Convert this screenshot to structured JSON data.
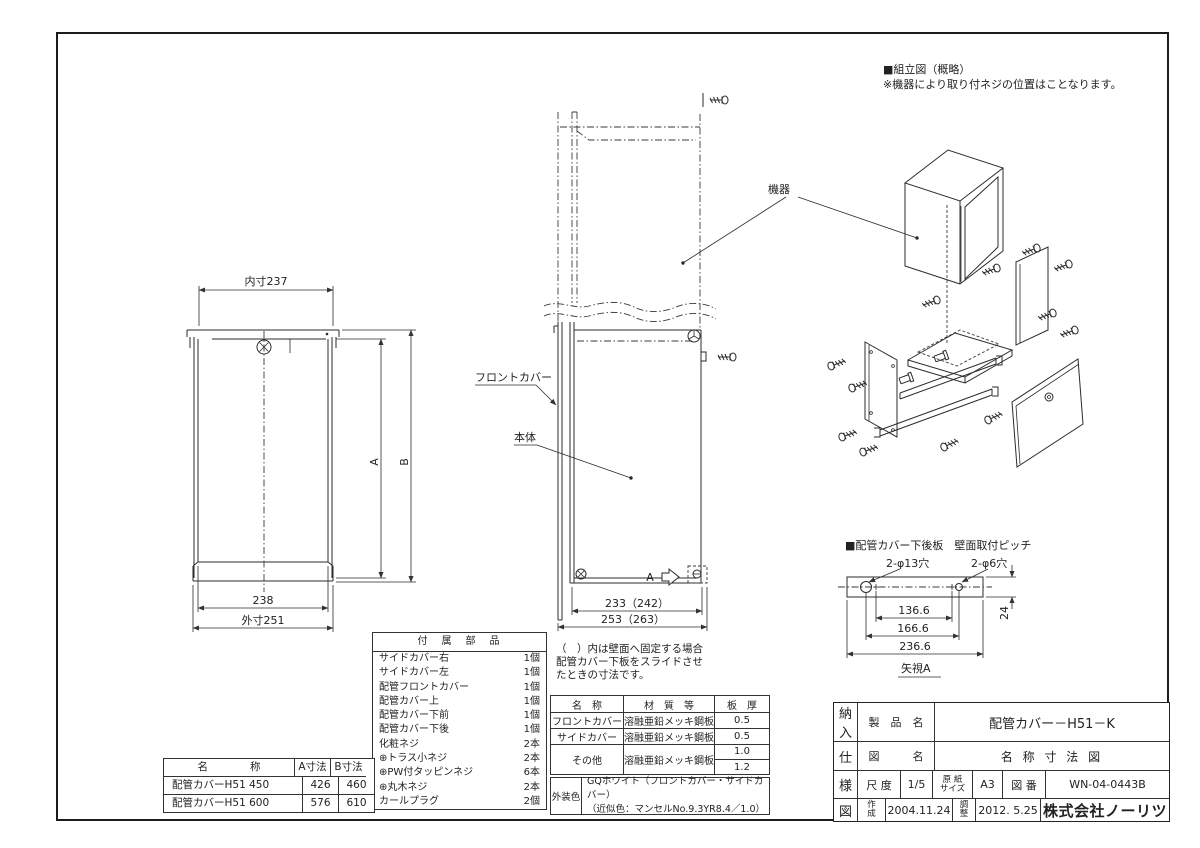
{
  "sheet": {
    "assembly_note_title": "■組立図（概略）",
    "assembly_note_body": "※機器により取り付ネジの位置はことなります。"
  },
  "front_view": {
    "dim_inner_width": "内寸237",
    "dim_width": "238",
    "dim_outer_width": "外寸251",
    "dim_a": "A",
    "dim_b": "B"
  },
  "side_view": {
    "label_front_cover": "フロントカバー",
    "label_body": "本体",
    "label_equipment": "機器",
    "dim_width": "233（242）",
    "dim_outer_width": "253（263）",
    "section_arrow": "A",
    "note_line1": "（　）内は壁面へ固定する場合",
    "note_line2": "配管カバー下板をスライドさせ",
    "note_line3": "たときの寸法です。"
  },
  "pitch_view": {
    "title": "■配管カバー下後板　壁面取付ピッチ",
    "hole_label_left": "2-φ13穴",
    "hole_label_right": "2-φ6穴",
    "dim_hole_pitch": "136.6",
    "dim_hole_centers": "166.6",
    "dim_overall": "236.6",
    "dim_height": "24",
    "view_label": "矢視A"
  },
  "parts_table": {
    "title": "付　属　部　品",
    "rows": [
      {
        "name": "サイドカバー右",
        "qty": "1個"
      },
      {
        "name": "サイドカバー左",
        "qty": "1個"
      },
      {
        "name": "配管フロントカバー",
        "qty": "1個"
      },
      {
        "name": "配管カバー上",
        "qty": "1個"
      },
      {
        "name": "配管カバー下前",
        "qty": "1個"
      },
      {
        "name": "配管カバー下後",
        "qty": "1個"
      },
      {
        "name": "化粧ネジ",
        "qty": "2本"
      },
      {
        "name": "⊕トラス小ネジ",
        "qty": "2本"
      },
      {
        "name": "⊕PW付タッピンネジ",
        "qty": "6本"
      },
      {
        "name": "⊕丸木ネジ",
        "qty": "2本"
      },
      {
        "name": "カールプラグ",
        "qty": "2個"
      }
    ]
  },
  "size_table": {
    "col_name": "名　　　　称",
    "col_a": "A寸法",
    "col_b": "B寸法",
    "rows": [
      {
        "name": "配管カバーH51 450",
        "a": "426",
        "b": "460"
      },
      {
        "name": "配管カバーH51 600",
        "a": "576",
        "b": "610"
      }
    ]
  },
  "material_table": {
    "col_name": "名　称",
    "col_material": "材　質　等",
    "col_thickness": "板　厚",
    "row1": {
      "name": "フロントカバー",
      "material": "溶融亜鉛メッキ鋼板",
      "thickness": "0.5"
    },
    "row2": {
      "name": "サイドカバー",
      "material": "溶融亜鉛メッキ鋼板",
      "thickness": "0.5"
    },
    "row3": {
      "name": "その他",
      "material": "溶融亜鉛メッキ鋼板",
      "thickness1": "1.0",
      "thickness2": "1.2"
    }
  },
  "color_spec": {
    "label": "外装色",
    "line1": "GQホワイト（フロントカバー・サイドカバー）",
    "line2": "（近似色：マンセルNo.9.3YR8.4／1.0）"
  },
  "title_block": {
    "doc_chars": [
      "納",
      "入",
      "仕",
      "様",
      "図"
    ],
    "product_label": "製　品　名",
    "product_value": "配管カバー－H51－K",
    "drawing_label": "図　　　名",
    "drawing_value": "名 称 寸 法 図",
    "scale_label": "尺 度",
    "scale_value": "1/5",
    "paper_label_1": "原 紙",
    "paper_label_2": "サイズ",
    "paper_value": "A3",
    "number_label": "図 番",
    "number_value": "WN-04-0443B",
    "created_label_1": "作",
    "created_label_2": "成",
    "created_value": "2004.11.24",
    "revised_label_1": "調",
    "revised_label_2": "整",
    "revised_value": "2012. 5.25",
    "company": "株式会社ノーリツ"
  }
}
